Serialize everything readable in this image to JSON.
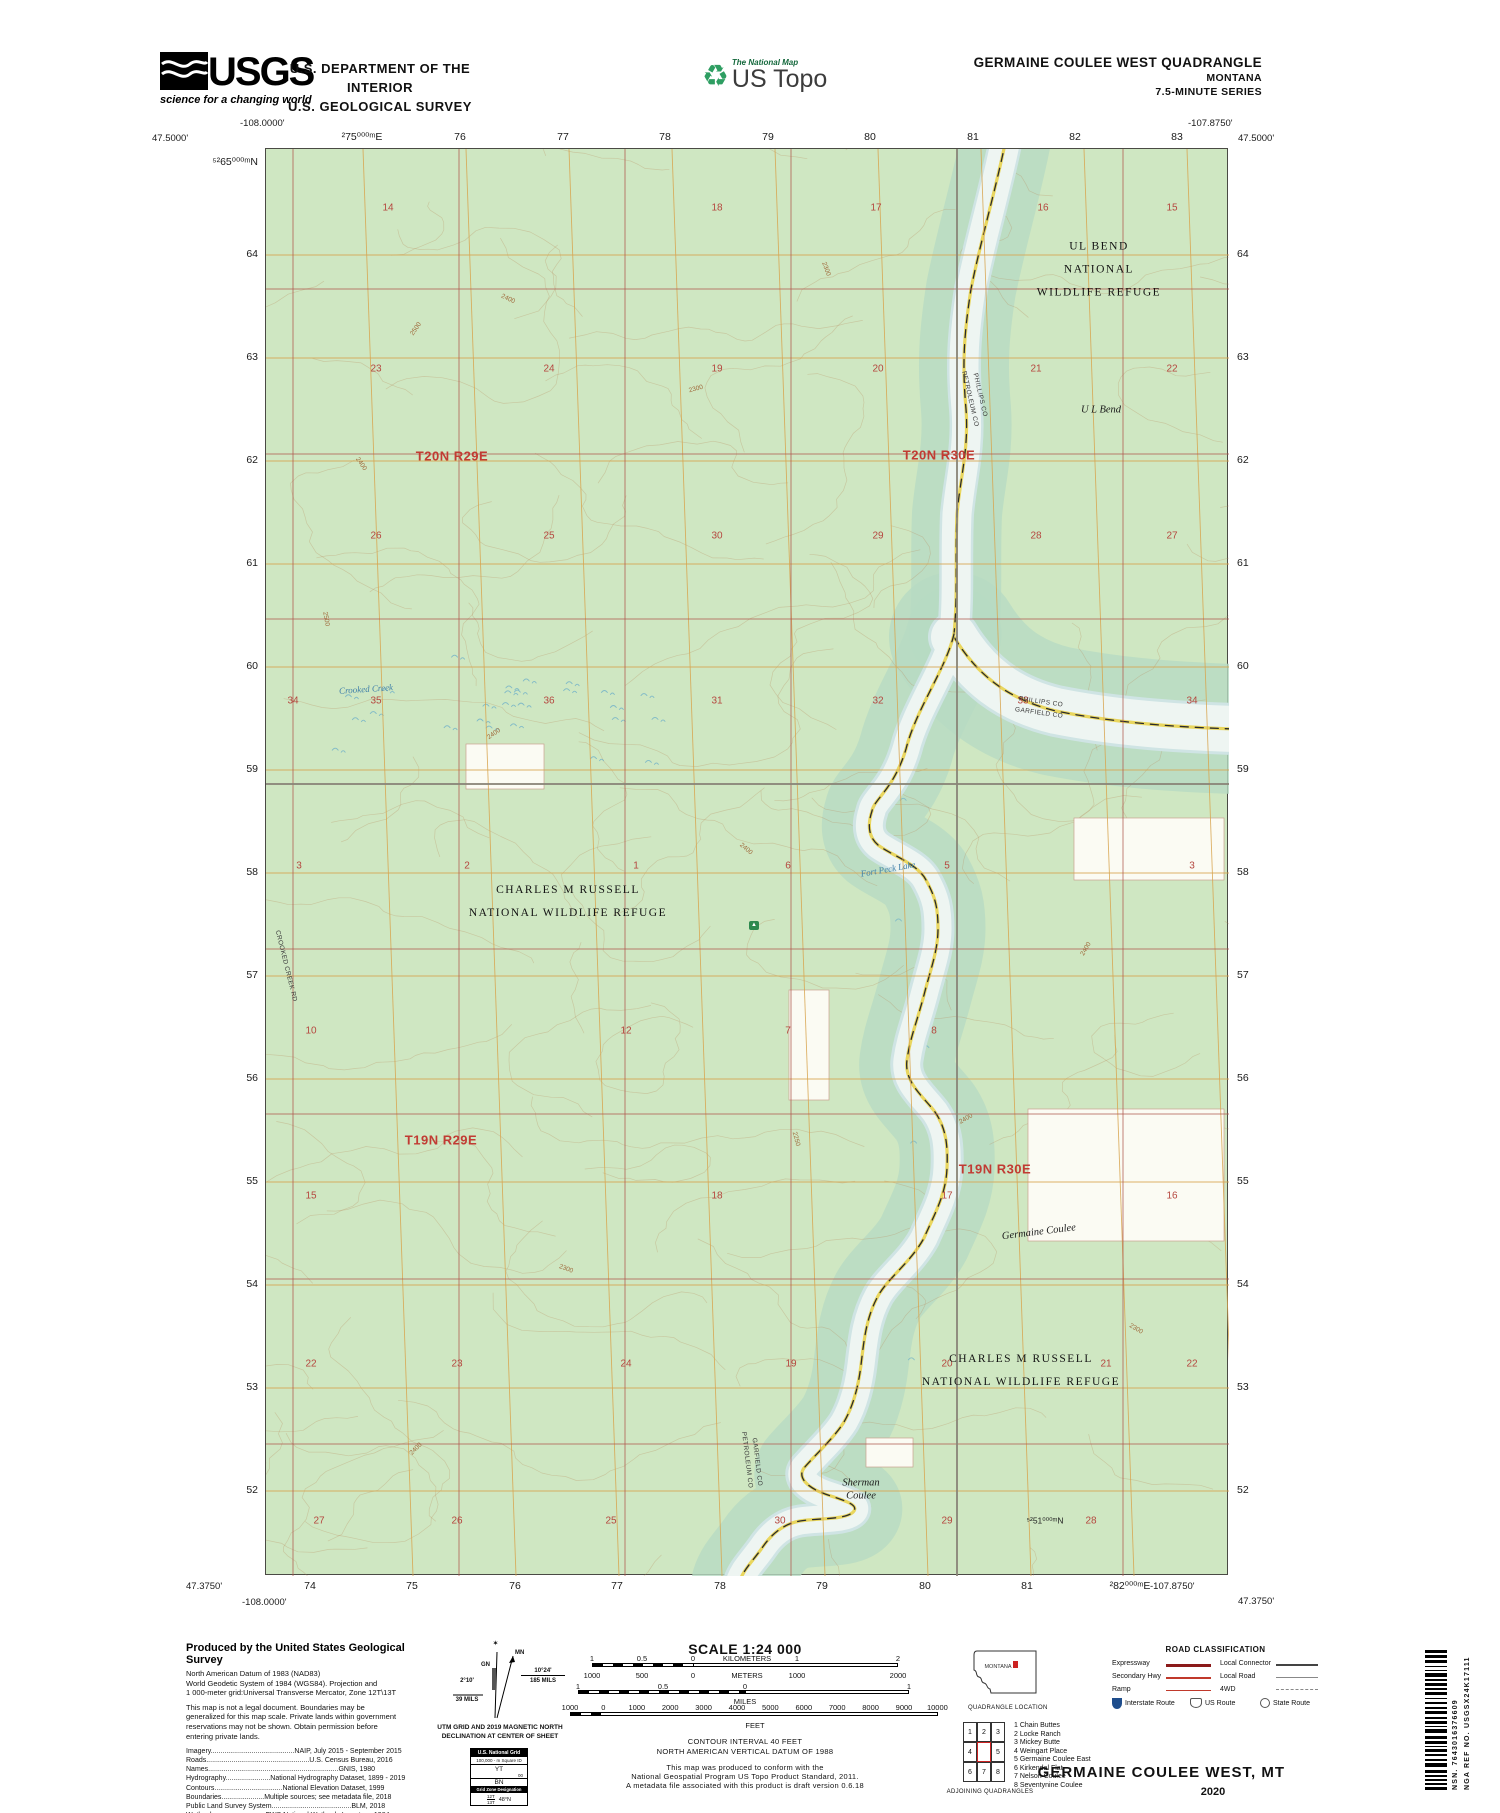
{
  "header": {
    "usgs_logo": "USGS",
    "usgs_tagline": "science for a changing world",
    "dept_line1": "U.S. DEPARTMENT OF THE INTERIOR",
    "dept_line2": "U.S. GEOLOGICAL SURVEY",
    "tnm_label": "The National Map",
    "ustopo_label": "US Topo",
    "quad_title": "GERMAINE COULEE WEST QUADRANGLE",
    "quad_state": "MONTANA",
    "quad_series": "7.5-MINUTE SERIES"
  },
  "map": {
    "corners": {
      "top_left_lon": "-108.0000'",
      "top_left_lat": "47.5000'",
      "top_right_lon": "-107.8750'",
      "top_right_lat": "47.5000'",
      "bottom_left_lat": "47.3750'",
      "bottom_left_lon": "-108.0000'",
      "bottom_right_lon": "-107.8750'",
      "bottom_right_lat": "47.3750'"
    },
    "top_edge": [
      {
        "t": "²75⁰⁰⁰ᵐE",
        "x": 97
      },
      {
        "t": "76",
        "x": 195
      },
      {
        "t": "77",
        "x": 298
      },
      {
        "t": "78",
        "x": 400
      },
      {
        "t": "79",
        "x": 503
      },
      {
        "t": "80",
        "x": 605
      },
      {
        "t": "81",
        "x": 708
      },
      {
        "t": "82",
        "x": 810
      },
      {
        "t": "83",
        "x": 912
      }
    ],
    "bottom_edge": [
      {
        "t": "74",
        "x": 45
      },
      {
        "t": "75",
        "x": 147
      },
      {
        "t": "76",
        "x": 250
      },
      {
        "t": "77",
        "x": 352
      },
      {
        "t": "78",
        "x": 455
      },
      {
        "t": "79",
        "x": 557
      },
      {
        "t": "80",
        "x": 660
      },
      {
        "t": "81",
        "x": 762
      },
      {
        "t": "²82⁰⁰⁰ᵐE",
        "x": 865
      }
    ],
    "left_edge": [
      {
        "t": "⁵²65⁰⁰⁰ᵐN",
        "y": 14
      },
      {
        "t": "64",
        "y": 106
      },
      {
        "t": "63",
        "y": 209
      },
      {
        "t": "62",
        "y": 312
      },
      {
        "t": "61",
        "y": 415
      },
      {
        "t": "60",
        "y": 518
      },
      {
        "t": "59",
        "y": 621
      },
      {
        "t": "58",
        "y": 724
      },
      {
        "t": "57",
        "y": 827
      },
      {
        "t": "56",
        "y": 930
      },
      {
        "t": "55",
        "y": 1033
      },
      {
        "t": "54",
        "y": 1136
      },
      {
        "t": "53",
        "y": 1239
      },
      {
        "t": "52",
        "y": 1342
      }
    ],
    "right_edge": [
      {
        "t": "64",
        "y": 106
      },
      {
        "t": "63",
        "y": 209
      },
      {
        "t": "62",
        "y": 312
      },
      {
        "t": "61",
        "y": 415
      },
      {
        "t": "60",
        "y": 518
      },
      {
        "t": "59",
        "y": 621
      },
      {
        "t": "58",
        "y": 724
      },
      {
        "t": "57",
        "y": 827
      },
      {
        "t": "56",
        "y": 930
      },
      {
        "t": "55",
        "y": 1033
      },
      {
        "t": "54",
        "y": 1136
      },
      {
        "t": "53",
        "y": 1239
      },
      {
        "t": "52",
        "y": 1342
      }
    ],
    "section_numbers": [
      {
        "n": "14",
        "x": 122,
        "y": 59
      },
      {
        "n": "18",
        "x": 451,
        "y": 59
      },
      {
        "n": "17",
        "x": 610,
        "y": 59
      },
      {
        "n": "16",
        "x": 777,
        "y": 59
      },
      {
        "n": "15",
        "x": 906,
        "y": 59
      },
      {
        "n": "23",
        "x": 110,
        "y": 220
      },
      {
        "n": "24",
        "x": 283,
        "y": 220
      },
      {
        "n": "19",
        "x": 451,
        "y": 220
      },
      {
        "n": "20",
        "x": 612,
        "y": 220
      },
      {
        "n": "21",
        "x": 770,
        "y": 220
      },
      {
        "n": "22",
        "x": 906,
        "y": 220
      },
      {
        "n": "26",
        "x": 110,
        "y": 387
      },
      {
        "n": "25",
        "x": 283,
        "y": 387
      },
      {
        "n": "30",
        "x": 451,
        "y": 387
      },
      {
        "n": "29",
        "x": 612,
        "y": 387
      },
      {
        "n": "28",
        "x": 770,
        "y": 387
      },
      {
        "n": "27",
        "x": 906,
        "y": 387
      },
      {
        "n": "34",
        "x": 27,
        "y": 552
      },
      {
        "n": "35",
        "x": 110,
        "y": 552
      },
      {
        "n": "36",
        "x": 283,
        "y": 552
      },
      {
        "n": "31",
        "x": 451,
        "y": 552
      },
      {
        "n": "32",
        "x": 612,
        "y": 552
      },
      {
        "n": "33",
        "x": 757,
        "y": 552
      },
      {
        "n": "34",
        "x": 926,
        "y": 552
      },
      {
        "n": "3",
        "x": 33,
        "y": 717
      },
      {
        "n": "2",
        "x": 201,
        "y": 717
      },
      {
        "n": "1",
        "x": 370,
        "y": 717
      },
      {
        "n": "6",
        "x": 522,
        "y": 717
      },
      {
        "n": "5",
        "x": 681,
        "y": 717
      },
      {
        "n": "3",
        "x": 926,
        "y": 717
      },
      {
        "n": "10",
        "x": 45,
        "y": 882
      },
      {
        "n": "12",
        "x": 360,
        "y": 882
      },
      {
        "n": "7",
        "x": 522,
        "y": 882
      },
      {
        "n": "8",
        "x": 668,
        "y": 882
      },
      {
        "n": "15",
        "x": 45,
        "y": 1047
      },
      {
        "n": "18",
        "x": 451,
        "y": 1047
      },
      {
        "n": "17",
        "x": 681,
        "y": 1047
      },
      {
        "n": "16",
        "x": 906,
        "y": 1047
      },
      {
        "n": "22",
        "x": 45,
        "y": 1215
      },
      {
        "n": "23",
        "x": 191,
        "y": 1215
      },
      {
        "n": "24",
        "x": 360,
        "y": 1215
      },
      {
        "n": "19",
        "x": 525,
        "y": 1215
      },
      {
        "n": "20",
        "x": 681,
        "y": 1215
      },
      {
        "n": "21",
        "x": 840,
        "y": 1215
      },
      {
        "n": "22",
        "x": 926,
        "y": 1215
      },
      {
        "n": "27",
        "x": 53,
        "y": 1372
      },
      {
        "n": "26",
        "x": 191,
        "y": 1372
      },
      {
        "n": "25",
        "x": 345,
        "y": 1372
      },
      {
        "n": "30",
        "x": 514,
        "y": 1372
      },
      {
        "n": "29",
        "x": 681,
        "y": 1372
      },
      {
        "n": "28",
        "x": 825,
        "y": 1372
      }
    ],
    "contour_labels": [
      {
        "t": "2500",
        "x": 150,
        "y": 180,
        "r": -55
      },
      {
        "t": "2400",
        "x": 242,
        "y": 150,
        "r": 25
      },
      {
        "t": "2400",
        "x": 95,
        "y": 315,
        "r": 55
      },
      {
        "t": "2300",
        "x": 430,
        "y": 240,
        "r": -15
      },
      {
        "t": "2400",
        "x": 228,
        "y": 585,
        "r": -35
      },
      {
        "t": "2500",
        "x": 60,
        "y": 470,
        "r": 80
      },
      {
        "t": "2400",
        "x": 480,
        "y": 700,
        "r": 40
      },
      {
        "t": "2300",
        "x": 560,
        "y": 120,
        "r": 70
      },
      {
        "t": "2400",
        "x": 700,
        "y": 970,
        "r": -30
      },
      {
        "t": "2300",
        "x": 300,
        "y": 1120,
        "r": 20
      },
      {
        "t": "2400",
        "x": 150,
        "y": 1300,
        "r": -45
      },
      {
        "t": "2250",
        "x": 530,
        "y": 990,
        "r": 75
      },
      {
        "t": "2400",
        "x": 820,
        "y": 800,
        "r": -60
      },
      {
        "t": "2300",
        "x": 870,
        "y": 1180,
        "r": 30
      }
    ],
    "labels": [
      {
        "t": "T20N R29E",
        "x": 186,
        "y": 307,
        "c": "tr",
        "r": 0
      },
      {
        "t": "T20N R30E",
        "x": 673,
        "y": 306,
        "c": "tr",
        "r": 0
      },
      {
        "t": "T19N R29E",
        "x": 175,
        "y": 991,
        "c": "tr",
        "r": 0
      },
      {
        "t": "T19N R30E",
        "x": 729,
        "y": 1020,
        "c": "tr",
        "r": 0
      },
      {
        "t": "UL BEND NATIONAL\nWILDLIFE REFUGE",
        "x": 833,
        "y": 121,
        "c": "refuge",
        "r": 0
      },
      {
        "t": "CHARLES M RUSSELL\nNATIONAL WILDLIFE REFUGE",
        "x": 302,
        "y": 753,
        "c": "refuge",
        "r": 0
      },
      {
        "t": "CHARLES M RUSSELL\nNATIONAL WILDLIFE REFUGE",
        "x": 755,
        "y": 1222,
        "c": "refuge",
        "r": 0
      },
      {
        "t": "U L Bend",
        "x": 835,
        "y": 262,
        "c": "place",
        "r": 0
      },
      {
        "t": "Germaine Coulee",
        "x": 773,
        "y": 1084,
        "c": "place",
        "r": -7
      },
      {
        "t": "Sherman\nCoulee",
        "x": 595,
        "y": 1341,
        "c": "place",
        "r": 0
      },
      {
        "t": "Fort Peck Lake",
        "x": 622,
        "y": 720,
        "c": "water",
        "r": -10
      },
      {
        "t": "Crooked Creek",
        "x": 100,
        "y": 540,
        "c": "water",
        "r": -4
      },
      {
        "t": "PHILLIPS CO",
        "x": 714,
        "y": 246,
        "c": "county",
        "r": 77
      },
      {
        "t": "PETROLEUM CO",
        "x": 704,
        "y": 250,
        "c": "county",
        "r": 77
      },
      {
        "t": "PHILLIPS CO",
        "x": 775,
        "y": 553,
        "c": "county",
        "r": 8
      },
      {
        "t": "GARFIELD CO",
        "x": 773,
        "y": 564,
        "c": "county",
        "r": 8
      },
      {
        "t": "PETROLEUM CO",
        "x": 481,
        "y": 1311,
        "c": "county",
        "r": 83
      },
      {
        "t": "GARFIELD CO",
        "x": 491,
        "y": 1313,
        "c": "county",
        "r": 83
      },
      {
        "t": "CROOKED CREEK RD",
        "x": 20,
        "y": 817,
        "c": "roadlbl",
        "r": 76
      },
      {
        "t": "⁵²51⁰⁰⁰ᵐN",
        "x": 779,
        "y": 1372,
        "c": "gridlbl",
        "r": 0
      }
    ]
  },
  "footer": {
    "produced_title": "Produced by the United States Geological Survey",
    "datum_lines": [
      "North American Datum of 1983 (NAD83)",
      "World Geodetic System of 1984 (WGS84).  Projection and",
      "1 000-meter grid:Universal Transverse Mercator, Zone 12T\\13T"
    ],
    "legal_lines": [
      "This map is not a legal document. Boundaries may be",
      "generalized for this map scale. Private lands within government",
      "reservations may not be shown. Obtain permission before",
      "entering private lands."
    ],
    "credits": [
      "Imagery...........................................NAIP, July 2015 - September 2015",
      "Roads.....................................................U.S. Census Bureau, 2016",
      "Names...................................................................GNIS, 1980",
      "Hydrography.......................National Hydrography Dataset, 1899 - 2019",
      "Contours...................................National Elevation Dataset, 1999",
      "Boundaries......................Multiple sources; see metadata file, 2018",
      "Public Land Survey System.........................................BLM, 2018",
      "Wetlands..........................FWS National Wetlands Inventory, 1984"
    ],
    "declination": {
      "star": "✶",
      "gn_label": "GN",
      "mn_label": "MN",
      "gn_deg": "2°10'",
      "gn_mils": "39 MILS",
      "mn_deg": "10°24'",
      "mn_mils": "185 MILS",
      "caption1": "UTM GRID AND 2019 MAGNETIC NORTH",
      "caption2": "DECLINATION AT CENTER OF SHEET"
    },
    "usng": {
      "title": "U.S. National Grid",
      "square_label": "100,000 - m Square ID",
      "id_top": "YT",
      "id_mid": "00",
      "id_bottom": "BN",
      "gzd_label": "Grid Zone Designation",
      "gzd_top": "12T",
      "gzd_bottom": "13T",
      "gzd_lat": "48°N"
    },
    "scale": {
      "title": "SCALE 1:24 000",
      "km": [
        "1",
        "0.5",
        "0",
        "KILOMETERS",
        "1",
        "2"
      ],
      "m": [
        "1000",
        "500",
        "0",
        "METERS",
        "1000",
        "2000"
      ],
      "mi": [
        "1",
        "0.5",
        "0",
        "1"
      ],
      "mi_unit": "MILES",
      "ft": [
        "1000",
        "0",
        "1000",
        "2000",
        "3000",
        "4000",
        "5000",
        "6000",
        "7000",
        "8000",
        "9000",
        "10000"
      ],
      "ft_unit": "FEET",
      "contour1": "CONTOUR INTERVAL 40 FEET",
      "contour2": "NORTH AMERICAN VERTICAL DATUM OF 1988",
      "conform1": "This map was produced to conform with the",
      "conform2": "National Geospatial Program US Topo Product Standard, 2011.",
      "conform3": "A metadata file associated with this product is draft version 0.6.18"
    },
    "location": {
      "state_label": "MONTANA",
      "caption": "QUADRANGLE LOCATION"
    },
    "adjoining": {
      "numbers": [
        "1",
        "2",
        "3",
        "4",
        "5",
        "6",
        "7",
        "8"
      ],
      "names": [
        "1 Chain Buttes",
        "2 Locke Ranch",
        "3 Mickey Butte",
        "4 Weingart Place",
        "5 Germaine Coulee East",
        "6 Kirkendal Flat",
        "7 Nelson Coulee",
        "8 Seventynine Coulee"
      ],
      "caption": "ADJOINING QUADRANGLES"
    },
    "road_class": {
      "title": "ROAD CLASSIFICATION",
      "rows_left": [
        "Expressway",
        "Secondary Hwy",
        "Ramp"
      ],
      "rows_right": [
        "Local Connector",
        "Local Road",
        "4WD"
      ],
      "shield_labels": [
        "Interstate Route",
        "US Route",
        "State Route"
      ]
    },
    "sheet_title": "GERMAINE COULEE WEST,  MT",
    "sheet_year": "2020",
    "barcode_nsn": "NSN. 7643016376609",
    "barcode_nga": "NGA REF NO. USGSX24K17111"
  },
  "colors": {
    "map_green": "#cfe7c2",
    "valley_green": "#b6dbc3",
    "water": "#eef5f2",
    "contour": "#b98d5e",
    "utm_grid": "#d8a54f",
    "section_grid": "#b0584e",
    "red_label": "#c13b33",
    "county_road_yellow": "#e8d455",
    "interstate_blue": "#1e4d8c"
  }
}
